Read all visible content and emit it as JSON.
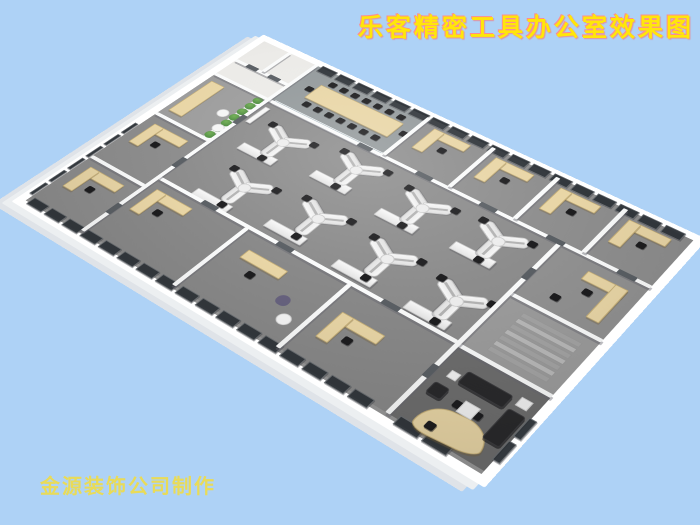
{
  "title": {
    "text": "乐客精密工具办公室效果图",
    "color": "#ffe60a",
    "outline": "#ff8d8d"
  },
  "watermark": {
    "text": "金源装饰公司制作",
    "color": "#eedc4a"
  },
  "scene": {
    "colors": {
      "bg": "#aed2f6",
      "window": "#33383d",
      "desk": "#e9d6a6",
      "desk_border": "#c7b078",
      "chair": "#1d1d1f",
      "door": "#5a5f64",
      "sofa": "#2a2a2c",
      "plant": "#3f7c38",
      "glass": "rgba(202,224,234,0.55)",
      "step_a": "#b9b9b9",
      "step_b": "#a4a4a4"
    },
    "floors": [
      [
        8,
        8,
        82,
        82,
        "#ecebe8"
      ],
      [
        90,
        8,
        160,
        82,
        "#949a9c"
      ],
      [
        250,
        8,
        318,
        82,
        "#8e8e8e"
      ],
      [
        90,
        95,
        375,
        168,
        "#8c8c8c"
      ],
      [
        470,
        95,
        98,
        85,
        "#919191"
      ],
      [
        470,
        185,
        98,
        80,
        "#9c9c9c"
      ],
      [
        8,
        95,
        77,
        90,
        "#9d9d9d"
      ],
      [
        8,
        190,
        77,
        182,
        "#8d8d8d"
      ],
      [
        90,
        268,
        375,
        104,
        "#898989"
      ],
      [
        470,
        270,
        98,
        102,
        "#6e6e6e"
      ]
    ],
    "walls": [
      [
        8,
        90,
        560,
        5
      ],
      [
        8,
        185,
        77,
        5
      ],
      [
        8,
        282,
        77,
        5
      ],
      [
        90,
        263,
        375,
        5
      ],
      [
        470,
        180,
        98,
        5
      ],
      [
        470,
        265,
        98,
        5
      ],
      [
        8,
        55,
        77,
        5
      ],
      [
        85,
        8,
        5,
        364
      ],
      [
        245,
        8,
        5,
        82
      ],
      [
        330,
        8,
        5,
        82
      ],
      [
        410,
        8,
        5,
        82
      ],
      [
        490,
        8,
        5,
        82
      ],
      [
        465,
        95,
        5,
        277
      ],
      [
        45,
        8,
        5,
        47
      ],
      [
        210,
        268,
        5,
        104
      ],
      [
        340,
        268,
        5,
        104
      ]
    ],
    "glass": [
      [
        95,
        88,
        150,
        8
      ]
    ],
    "top_band": {
      "x0": 94,
      "x1": 566,
      "y": 4,
      "w": 22,
      "h": 13,
      "step": 26
    },
    "bottom_band": {
      "x0": 12,
      "x1": 466,
      "y": 367,
      "w": 22,
      "h": 12,
      "step": 26
    },
    "left_band": {
      "x": 2,
      "y0": 214,
      "y1": 366,
      "w": 5,
      "h": 22,
      "step": 26
    },
    "extra_windows": [
      [
        566,
        300,
        8,
        26
      ],
      [
        566,
        332,
        8,
        26
      ],
      [
        478,
        367,
        26,
        12
      ],
      [
        508,
        367,
        26,
        12
      ]
    ],
    "desk_rects": [
      [
        116,
        34,
        116,
        30
      ],
      [
        14,
        105,
        20,
        70
      ],
      [
        263,
        20,
        48,
        14
      ],
      [
        263,
        20,
        14,
        42
      ],
      [
        343,
        20,
        48,
        14
      ],
      [
        343,
        20,
        14,
        42
      ],
      [
        423,
        20,
        48,
        14
      ],
      [
        423,
        20,
        14,
        42
      ],
      [
        503,
        20,
        48,
        14
      ],
      [
        503,
        20,
        14,
        42
      ],
      [
        510,
        110,
        44,
        14
      ],
      [
        540,
        110,
        14,
        55
      ],
      [
        100,
        280,
        50,
        14
      ],
      [
        100,
        280,
        14,
        40
      ],
      [
        235,
        290,
        50,
        14
      ],
      [
        360,
        300,
        50,
        14
      ],
      [
        360,
        300,
        14,
        40
      ],
      [
        20,
        202,
        50,
        14
      ],
      [
        20,
        202,
        14,
        40
      ],
      [
        20,
        297,
        50,
        14
      ],
      [
        20,
        297,
        14,
        40
      ]
    ],
    "cabinets": [
      [
        118,
        166
      ],
      [
        208,
        154
      ],
      [
        298,
        160
      ],
      [
        386,
        154
      ],
      [
        132,
        252
      ],
      [
        222,
        242
      ],
      [
        312,
        246
      ],
      [
        400,
        248
      ]
    ],
    "ydesks": [
      [
        150,
        140
      ],
      [
        240,
        128
      ],
      [
        330,
        134
      ],
      [
        418,
        128
      ],
      [
        168,
        222
      ],
      [
        258,
        212
      ],
      [
        348,
        216
      ],
      [
        434,
        222
      ]
    ],
    "chairs": [
      [
        287,
        42
      ],
      [
        367,
        42
      ],
      [
        447,
        42
      ],
      [
        527,
        42
      ],
      [
        520,
        132
      ],
      [
        500,
        156
      ],
      [
        122,
        302
      ],
      [
        255,
        312
      ],
      [
        382,
        322
      ],
      [
        42,
        224
      ],
      [
        42,
        319
      ],
      [
        505,
        322
      ],
      [
        525,
        322
      ],
      [
        500,
        356
      ]
    ],
    "conference": {
      "row_top": {
        "x0": 122,
        "y": 22,
        "dx": 16,
        "count": 7
      },
      "row_bottom": {
        "x0": 122,
        "y": 68,
        "dx": 16,
        "count": 7
      },
      "end_chairs": [
        [
          106,
          44
        ],
        [
          238,
          44
        ]
      ]
    },
    "plants": {
      "x": 76,
      "y0": 100,
      "dy": 13,
      "count": 7
    },
    "stairs": {
      "x": 492,
      "y0": 196,
      "dy": 9,
      "w": 64,
      "h": 7,
      "count": 7
    },
    "sofa_rects": [
      [
        494,
        288,
        48,
        18
      ],
      [
        546,
        302,
        18,
        42
      ],
      [
        478,
        316,
        16,
        16
      ]
    ],
    "white_tables": [
      [
        512,
        318,
        16,
        16
      ],
      [
        482,
        296,
        10,
        10
      ],
      [
        548,
        284,
        12,
        12
      ]
    ],
    "round_tables": [
      [
        58,
        135,
        14,
        14
      ],
      [
        72,
        158,
        14,
        14
      ],
      [
        316,
        334,
        15,
        15
      ]
    ],
    "tub_chairs": [
      [
        300,
        316,
        14,
        14
      ]
    ],
    "doors": [
      [
        292,
        89,
        20,
        7
      ],
      [
        372,
        89,
        20,
        7
      ],
      [
        452,
        89,
        20,
        7
      ],
      [
        532,
        89,
        20,
        7
      ],
      [
        215,
        89,
        18,
        7
      ],
      [
        150,
        262,
        20,
        7
      ],
      [
        250,
        262,
        20,
        7
      ],
      [
        380,
        262,
        20,
        7
      ],
      [
        84,
        130,
        7,
        18
      ],
      [
        84,
        225,
        7,
        18
      ],
      [
        84,
        320,
        7,
        18
      ],
      [
        464,
        140,
        7,
        18
      ],
      [
        464,
        300,
        7,
        18
      ],
      [
        25,
        54,
        16,
        7
      ],
      [
        58,
        54,
        16,
        7
      ]
    ]
  }
}
